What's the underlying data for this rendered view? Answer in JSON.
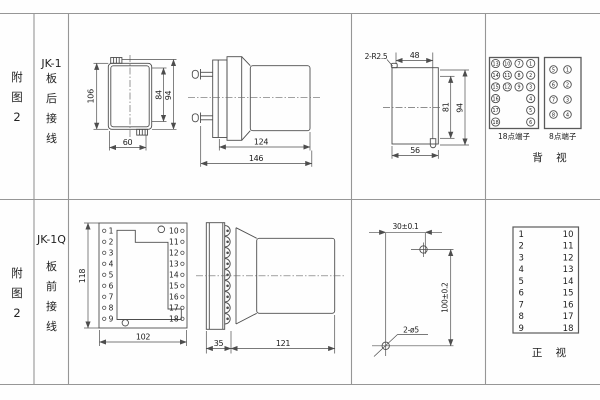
{
  "colors": {
    "line": "#4d4d4d",
    "grid": "#969696",
    "text": "#1c1c1c"
  },
  "row1": {
    "figure_label": "附图2",
    "model": "JK-1",
    "wiring_label": "板后接线",
    "front_view": {
      "height": "106",
      "case_height": "84",
      "flange_height": "94",
      "width": "60"
    },
    "side_view": {
      "depth_body": "124",
      "depth_total": "146"
    },
    "cutout": {
      "slot_label": "2-R2.5",
      "slot_spacing": "48",
      "opening_height": "81",
      "total_height": "94",
      "opening_width": "56"
    },
    "terminals18": {
      "label": "18点端子",
      "rows": [
        [
          "13",
          "10",
          "7",
          "1"
        ],
        [
          "14",
          "11",
          "8",
          "2"
        ],
        [
          "15",
          "12",
          "9",
          "3"
        ],
        [
          "16",
          "4"
        ],
        [
          "17",
          "5"
        ],
        [
          "18",
          "6"
        ]
      ]
    },
    "terminals8": {
      "label": "8点端子",
      "rows": [
        [
          "5",
          "1"
        ],
        [
          "6",
          "2"
        ],
        [
          "7",
          "3"
        ],
        [
          "8",
          "4"
        ]
      ]
    },
    "view_label": "背 视"
  },
  "row2": {
    "figure_label": "附图2",
    "model": "JK-1Q",
    "wiring_label": "板前接线",
    "front_view": {
      "height": "118",
      "width": "102",
      "left_terminals": [
        "1",
        "2",
        "3",
        "4",
        "5",
        "6",
        "7",
        "8",
        "9"
      ],
      "right_terminals": [
        "10",
        "11",
        "12",
        "13",
        "14",
        "15",
        "16",
        "17",
        "18"
      ]
    },
    "side_view": {
      "depth_front": "35",
      "depth_body": "121"
    },
    "drill_plan": {
      "hole_spacing_h": "30±0.1",
      "hole_spacing_v": "100±0.2",
      "hole_label": "2-ø5"
    },
    "terminal_table": {
      "left": [
        "1",
        "2",
        "3",
        "4",
        "5",
        "6",
        "7",
        "8",
        "9"
      ],
      "right": [
        "10",
        "11",
        "12",
        "13",
        "14",
        "15",
        "16",
        "17",
        "18"
      ]
    },
    "view_label": "正 视"
  }
}
